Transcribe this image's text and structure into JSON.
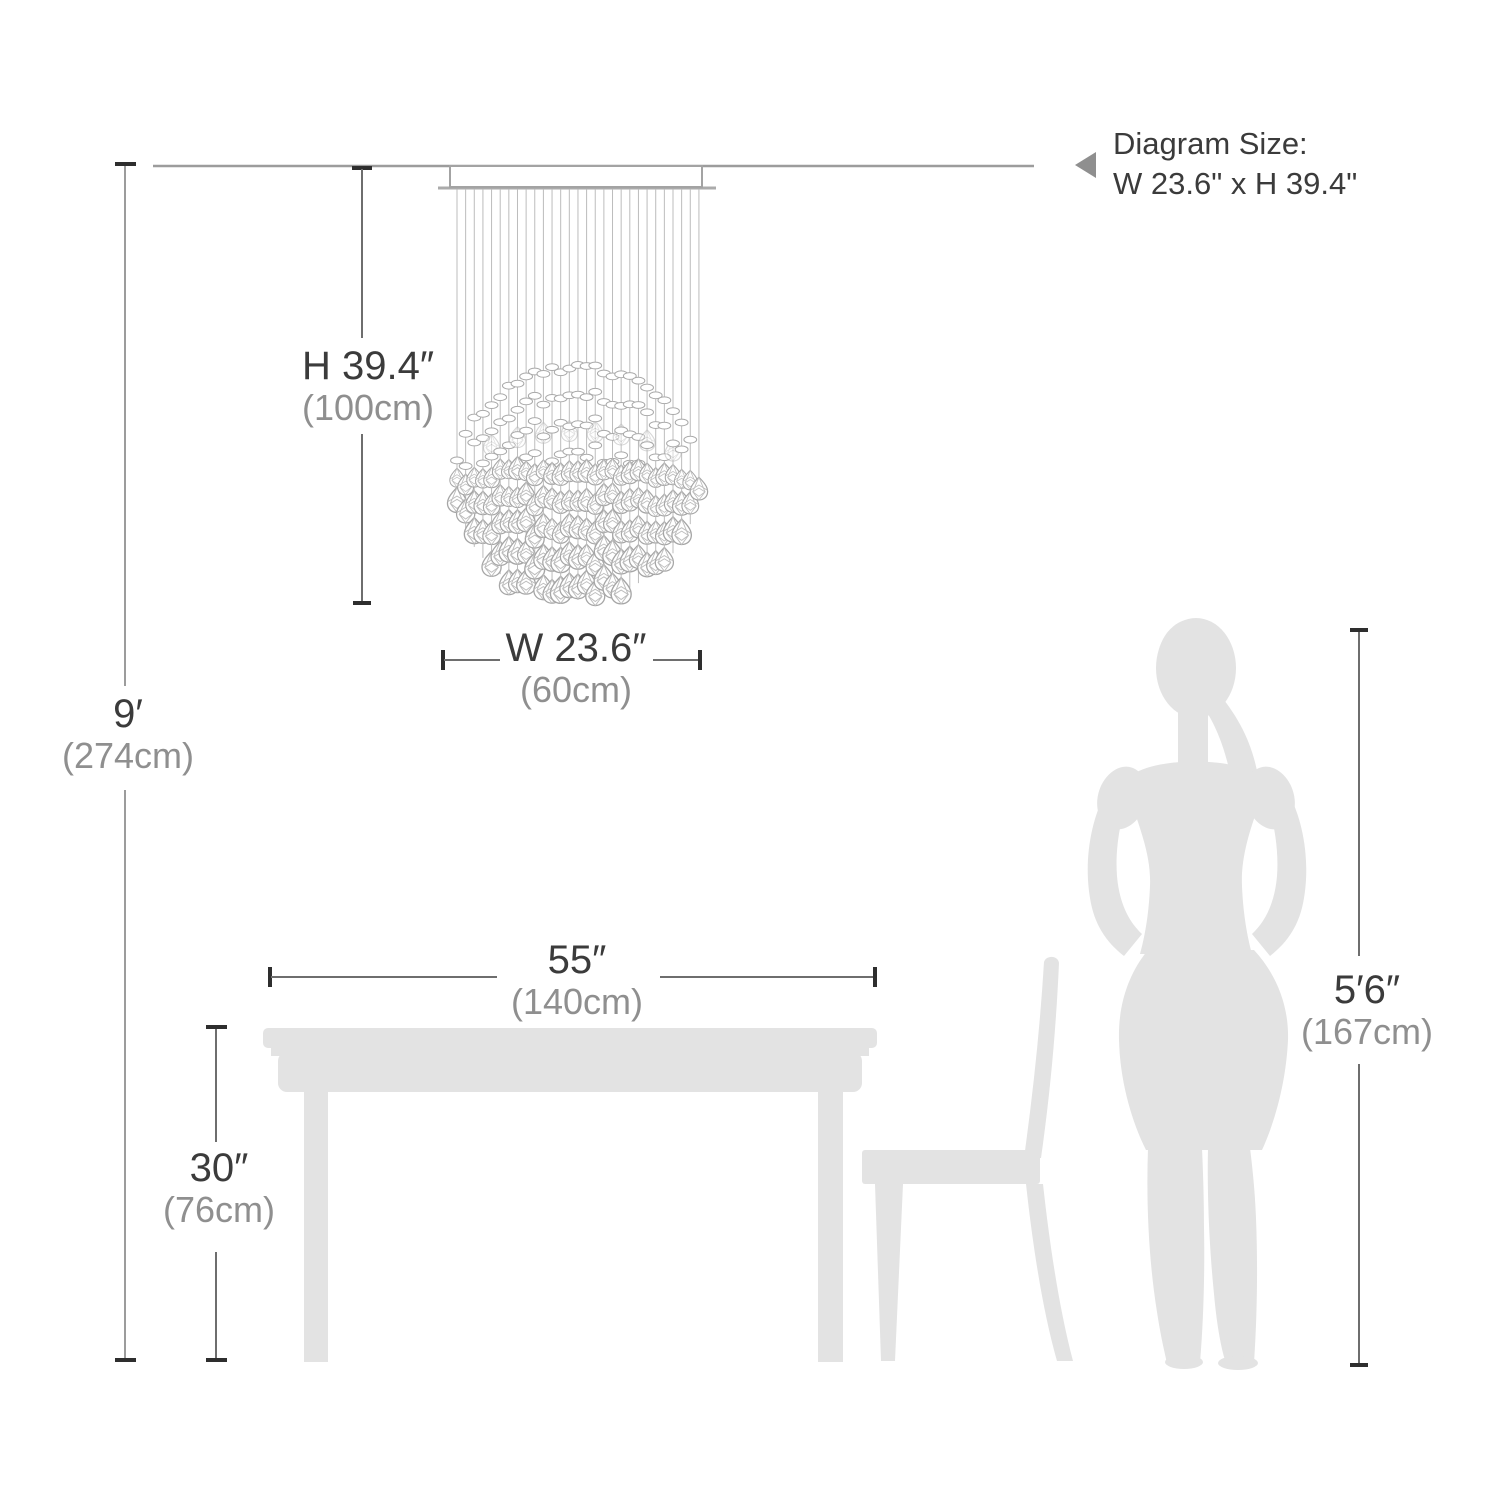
{
  "note": {
    "line1": "Diagram Size:",
    "line2": "W 23.6\" x H 39.4\""
  },
  "dimensions": {
    "fixture_height": {
      "imperial": "H 39.4″",
      "metric": "(100cm)"
    },
    "fixture_width": {
      "imperial": "W 23.6″",
      "metric": "(60cm)"
    },
    "ceiling_height": {
      "imperial": "9′",
      "metric": "(274cm)"
    },
    "table_width": {
      "imperial": "55″",
      "metric": "(140cm)"
    },
    "table_height": {
      "imperial": "30″",
      "metric": "(76cm)"
    },
    "person_height": {
      "imperial": "5′6″",
      "metric": "(167cm)"
    }
  },
  "colors": {
    "text_primary": "#3b3b3b",
    "text_secondary": "#8f8f8f",
    "silhouette": "#e3e3e3",
    "dim_line_dark": "#6e6e6e",
    "dim_line_light": "#9c9c9c",
    "tick": "#2e2e2e",
    "fixture_outline": "#a6a6a6",
    "note_arrow": "#8f8f8f"
  }
}
